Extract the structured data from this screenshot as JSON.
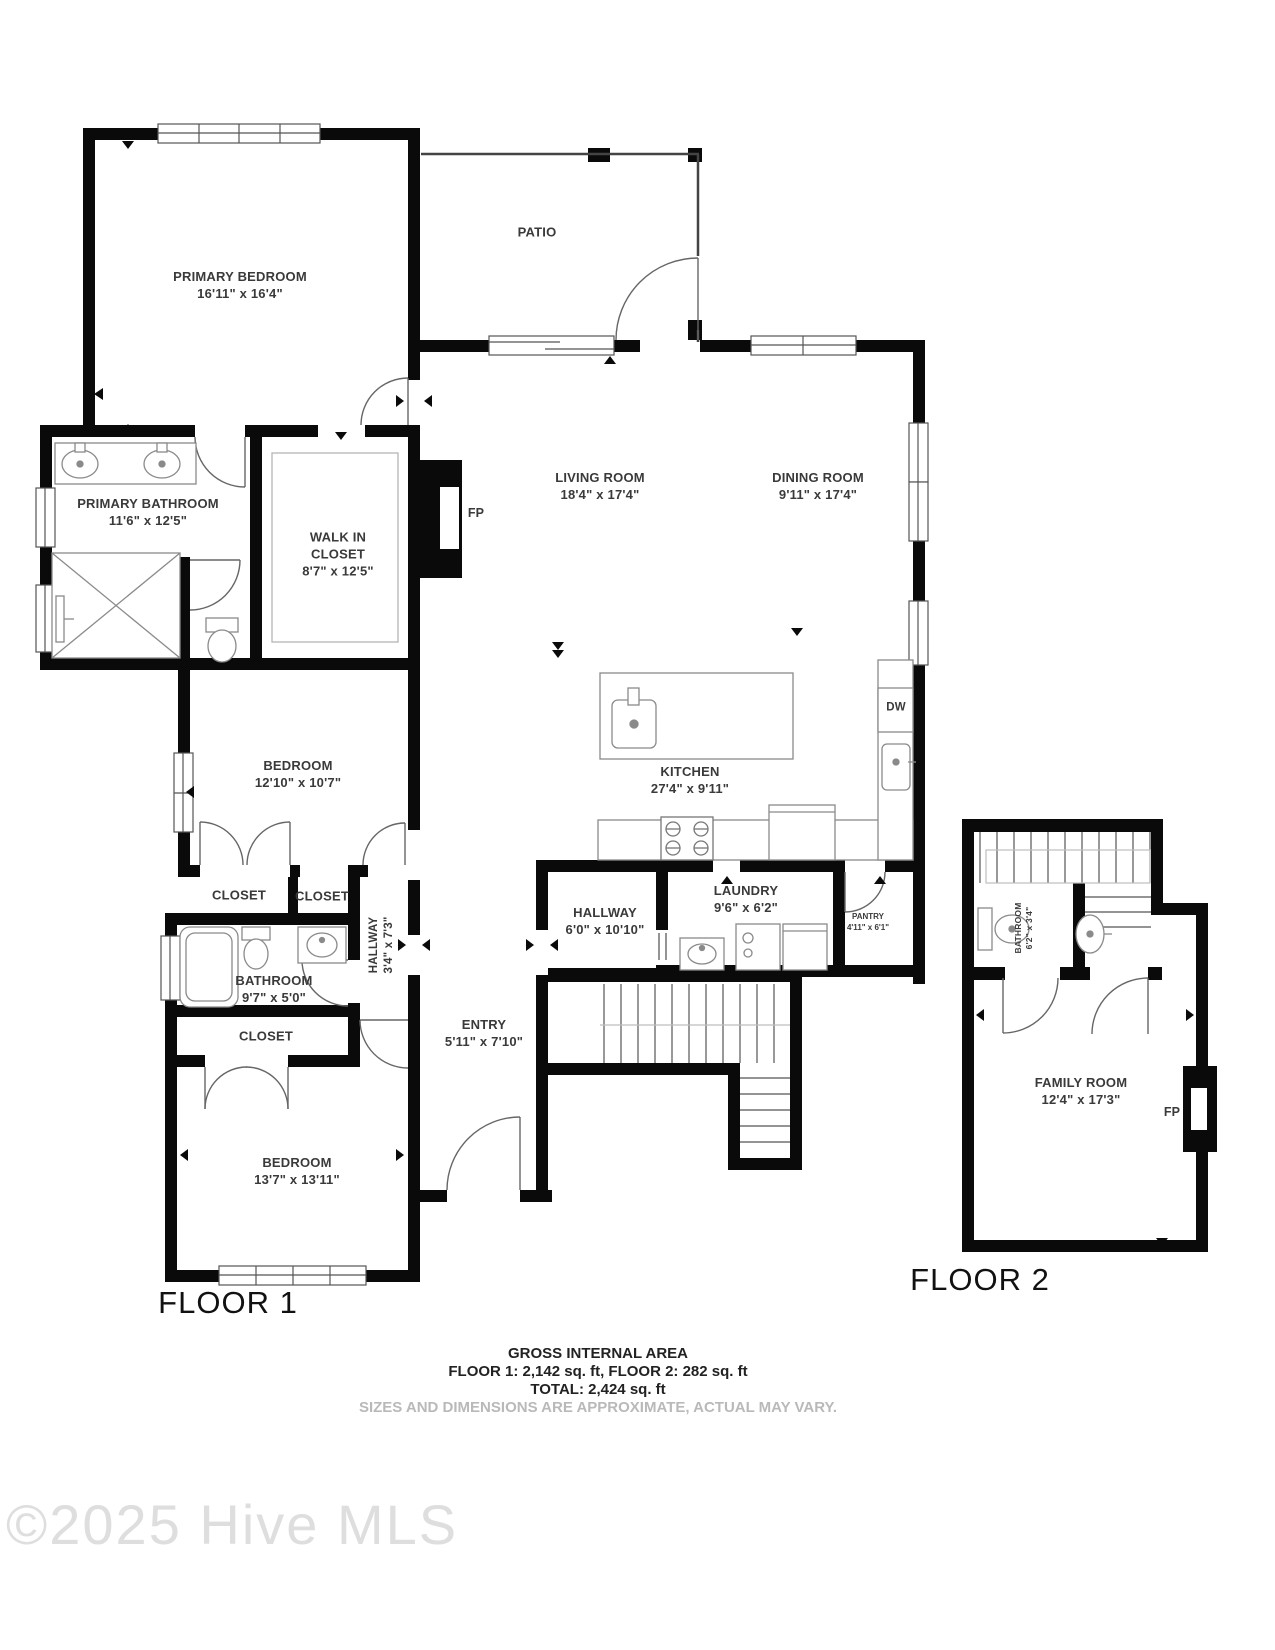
{
  "floor1": {
    "label": "FLOOR 1",
    "rooms": {
      "primary_bedroom": {
        "name": "PRIMARY BEDROOM",
        "dims": "16'11\" x 16'4\""
      },
      "patio": {
        "name": "PATIO"
      },
      "living_room": {
        "name": "LIVING ROOM",
        "dims": "18'4\" x 17'4\""
      },
      "dining_room": {
        "name": "DINING ROOM",
        "dims": "9'11\" x 17'4\""
      },
      "primary_bathroom": {
        "name": "PRIMARY BATHROOM",
        "dims": "11'6\" x 12'5\""
      },
      "walk_in_closet": {
        "name": "WALK IN CLOSET",
        "dims": "8'7\" x 12'5\""
      },
      "bedroom2": {
        "name": "BEDROOM",
        "dims": "12'10\" x 10'7\""
      },
      "closet_a": {
        "name": "CLOSET"
      },
      "closet_b": {
        "name": "CLOSET"
      },
      "bathroom": {
        "name": "BATHROOM",
        "dims": "9'7\" x 5'0\""
      },
      "hallway_small": {
        "name": "HALLWAY",
        "dims": "3'4\" x 7'3\""
      },
      "closet_c": {
        "name": "CLOSET"
      },
      "bedroom3": {
        "name": "BEDROOM",
        "dims": "13'7\" x 13'11\""
      },
      "entry": {
        "name": "ENTRY",
        "dims": "5'11\" x 7'10\""
      },
      "hallway": {
        "name": "HALLWAY",
        "dims": "6'0\" x 10'10\""
      },
      "laundry": {
        "name": "LAUNDRY",
        "dims": "9'6\" x 6'2\""
      },
      "pantry": {
        "name": "PANTRY",
        "dims": "4'11\" x 6'1\""
      },
      "kitchen": {
        "name": "KITCHEN",
        "dims": "27'4\" x 9'11\""
      }
    },
    "fireplace_label": "FP",
    "dishwasher_label": "DW"
  },
  "floor2": {
    "label": "FLOOR 2",
    "rooms": {
      "bathroom": {
        "name": "BATHROOM",
        "dims": "6'2\" x 3'4\""
      },
      "family_room": {
        "name": "FAMILY ROOM",
        "dims": "12'4\" x 17'3\""
      }
    },
    "fireplace_label": "FP"
  },
  "footer": {
    "line1": "GROSS INTERNAL AREA",
    "line2": "FLOOR 1: 2,142 sq. ft, FLOOR 2: 282 sq. ft",
    "line3": "TOTAL: 2,424 sq. ft",
    "line4": "SIZES AND DIMENSIONS ARE APPROXIMATE, ACTUAL MAY VARY."
  },
  "watermark": "©2025 Hive MLS"
}
